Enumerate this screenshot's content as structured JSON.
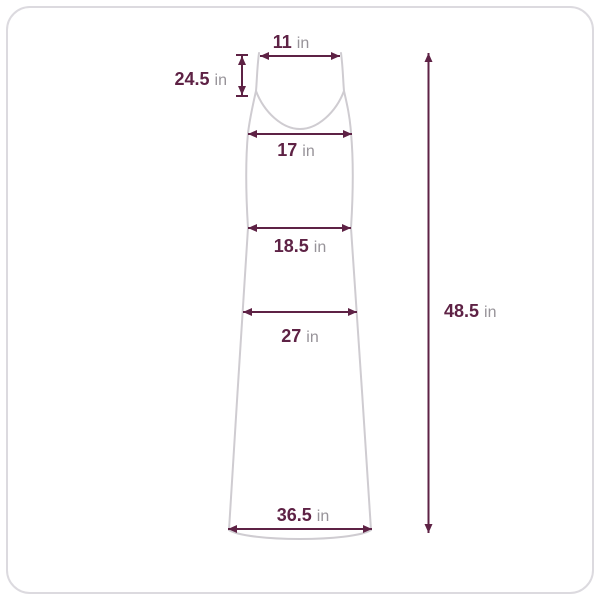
{
  "colors": {
    "dimension": "#5e2245",
    "unit_text": "#979399",
    "garment_outline": "#cfccd1",
    "card_border": "#dcdadf",
    "background": "#ffffff"
  },
  "measurements": {
    "shoulder_width": {
      "value": "11",
      "unit": "in"
    },
    "strap_drop": {
      "value": "24.5",
      "unit": "in"
    },
    "bust": {
      "value": "17",
      "unit": "in"
    },
    "waist": {
      "value": "18.5",
      "unit": "in"
    },
    "hip": {
      "value": "27",
      "unit": "in"
    },
    "hem": {
      "value": "36.5",
      "unit": "in"
    },
    "length": {
      "value": "48.5",
      "unit": "in"
    }
  }
}
